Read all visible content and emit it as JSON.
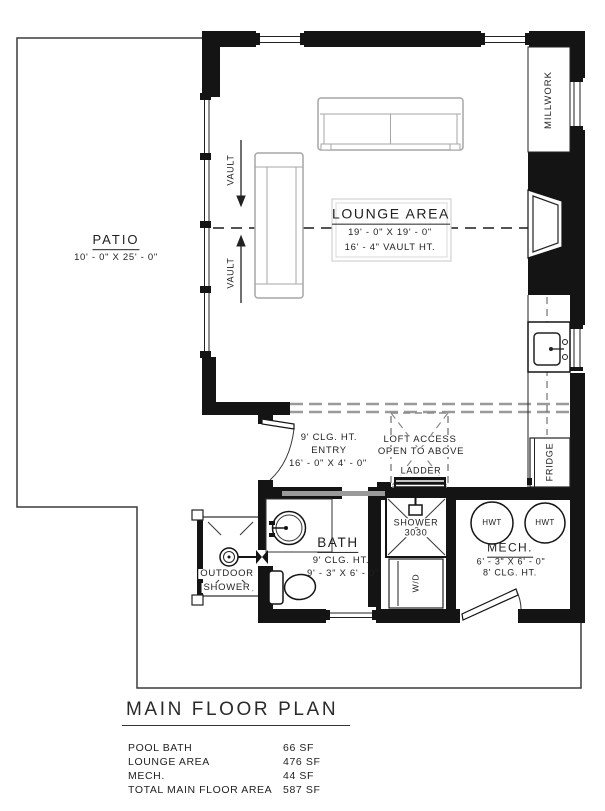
{
  "title": "MAIN FLOOR PLAN",
  "rooms": {
    "patio": {
      "name": "PATIO",
      "dims": "10' - 0\" X 25' - 0\""
    },
    "lounge": {
      "name": "LOUNGE AREA",
      "dims": "19' - 0\" X 19' - 0\"",
      "vault_ht": "16' - 4\" VAULT HT."
    },
    "entry": {
      "clg": "9' CLG. HT.",
      "name": "ENTRY",
      "dims": "16' - 0\" X 4' - 0\""
    },
    "bath": {
      "name": "BATH",
      "clg": "9' CLG. HT.",
      "dims": "9' - 3\" X 6' - 0\""
    },
    "mech": {
      "name": "MECH.",
      "dims": "6' - 3\" X 6' - 0\"",
      "clg": "8' CLG. HT."
    },
    "outdoor_shower": {
      "line1": "OUTDOOR",
      "line2": "SHOWER"
    }
  },
  "annotations": {
    "vault": "VAULT",
    "millwork": "MILLWORK",
    "fridge": "FRIDGE",
    "washer_dryer": "W/D",
    "hwt": "HWT",
    "loft_access": "LOFT ACCESS",
    "open_to_above": "OPEN TO ABOVE",
    "ladder": "LADDER",
    "shower_label": "SHOWER",
    "shower_size": "3030"
  },
  "area_schedule": {
    "rows": [
      {
        "label": "POOL BATH",
        "value": "66 SF"
      },
      {
        "label": "LOUNGE AREA",
        "value": "476 SF"
      },
      {
        "label": "MECH.",
        "value": "44 SF"
      },
      {
        "label": "TOTAL MAIN FLOOR AREA",
        "value": "587 SF"
      }
    ]
  },
  "colors": {
    "wall": "#141414",
    "thin_line": "#3c3c3c",
    "furniture_gray": "#a6a6a6",
    "dash_gray": "#9a9a9a"
  }
}
